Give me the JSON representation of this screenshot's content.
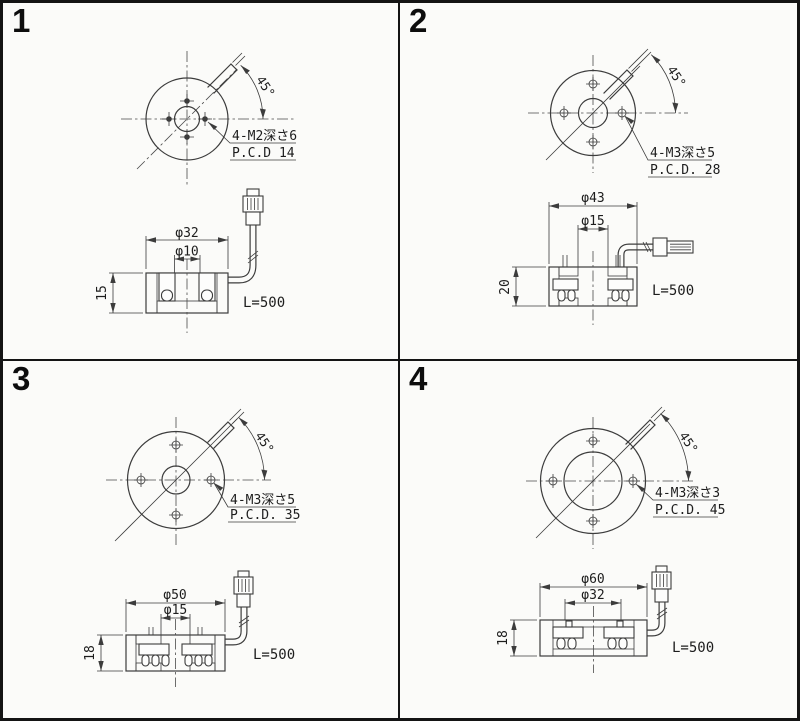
{
  "sheet": {
    "background_color": "#fbfbf9",
    "line_color": "#3c3c3c",
    "border_color": "#141414"
  },
  "panels": [
    {
      "number": "1",
      "top_view": {
        "angle_label": "45°",
        "thread_note": "4-M2深さ6",
        "pcd_note": "P.C.D 14"
      },
      "side_view": {
        "outer_diameter": "φ32",
        "inner_diameter": "φ10",
        "height": "15",
        "cable_length": "L=500"
      }
    },
    {
      "number": "2",
      "top_view": {
        "angle_label": "45°",
        "thread_note": "4-M3深さ5",
        "pcd_note": "P.C.D. 28"
      },
      "side_view": {
        "outer_diameter": "φ43",
        "inner_diameter": "φ15",
        "height": "20",
        "cable_length": "L=500"
      }
    },
    {
      "number": "3",
      "top_view": {
        "angle_label": "45°",
        "thread_note": "4-M3深さ5",
        "pcd_note": "P.C.D. 35"
      },
      "side_view": {
        "outer_diameter": "φ50",
        "inner_diameter": "φ15",
        "height": "18",
        "cable_length": "L=500"
      }
    },
    {
      "number": "4",
      "top_view": {
        "angle_label": "45°",
        "thread_note": "4-M3深さ3",
        "pcd_note": "P.C.D. 45"
      },
      "side_view": {
        "outer_diameter": "φ60",
        "inner_diameter": "φ32",
        "height": "18",
        "cable_length": "L=500"
      }
    }
  ]
}
